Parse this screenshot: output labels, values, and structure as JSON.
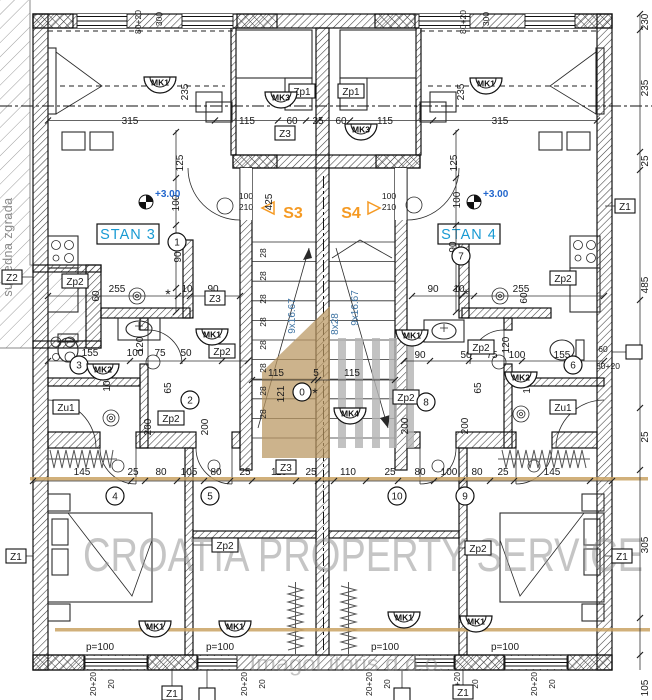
{
  "labels": {
    "stan3": "STAN 3",
    "stan4": "STAN 4",
    "s3": "S3",
    "s4": "S4",
    "level_mark": "+3.00",
    "neighbor": "susjedna zgrada"
  },
  "watermarks": {
    "main": "CROATIA PROPERTY SERVICE",
    "sub": "ImagoLitoris d.o.o."
  },
  "colors": {
    "dimension_text": "#1a1a1a",
    "stair_note_text": "#3f74a3",
    "unit_label_text": "#189ad3",
    "stair_id_text": "#f59a23",
    "level_text": "#2266cc",
    "watermark_tan": "#c9a263",
    "watermark_gray": "#8c8c8c"
  },
  "dim_labels": [
    [
      "80+20",
      141,
      22,
      -90,
      8.5
    ],
    [
      "300",
      162,
      19,
      -90,
      8.5
    ],
    [
      "80+20",
      466,
      22,
      -90,
      8.5
    ],
    [
      "300",
      489,
      19,
      -90,
      8.5
    ],
    [
      "315",
      130,
      124
    ],
    [
      "115",
      247,
      124
    ],
    [
      "60",
      292,
      124
    ],
    [
      "25",
      318,
      124
    ],
    [
      "60",
      341,
      124
    ],
    [
      "115",
      385,
      124
    ],
    [
      "315",
      500,
      124
    ],
    [
      "235",
      188,
      92,
      -90
    ],
    [
      "235",
      464,
      92,
      -90
    ],
    [
      "230",
      648,
      22,
      -90
    ],
    [
      "235",
      648,
      88,
      -90
    ],
    [
      "25",
      648,
      161,
      -90
    ],
    [
      "485",
      648,
      285,
      -90
    ],
    [
      "25",
      648,
      437,
      -90
    ],
    [
      "305",
      648,
      545,
      -90
    ],
    [
      "105",
      648,
      688,
      -90
    ],
    [
      "125",
      183,
      163,
      -90
    ],
    [
      "125",
      457,
      163,
      -90
    ],
    [
      "100",
      179,
      203,
      -90
    ],
    [
      "100",
      460,
      200,
      -90
    ],
    [
      "90",
      181,
      257,
      -90
    ],
    [
      "90",
      456,
      247,
      -90
    ],
    [
      "100",
      246,
      199,
      0,
      8.5
    ],
    [
      "210",
      246,
      210,
      0,
      8.5
    ],
    [
      "100",
      389,
      199,
      0,
      8.5
    ],
    [
      "210",
      389,
      210,
      0,
      8.5
    ],
    [
      "425",
      272,
      202,
      -90
    ],
    [
      "9x16.67",
      295,
      316,
      -90,
      10,
      "blue"
    ],
    [
      "8x28",
      338,
      324,
      -90,
      10,
      "blue"
    ],
    [
      "9x16.67",
      358,
      308,
      -90,
      10,
      "blue"
    ],
    [
      "28",
      266,
      253,
      -90,
      8.5
    ],
    [
      "28",
      266,
      276,
      -90,
      8.5
    ],
    [
      "28",
      266,
      299,
      -90,
      8.5
    ],
    [
      "28",
      266,
      322,
      -90,
      8.5
    ],
    [
      "28",
      266,
      345,
      -90,
      8.5
    ],
    [
      "28",
      266,
      368,
      -90,
      8.5
    ],
    [
      "28",
      266,
      391,
      -90,
      8.5
    ],
    [
      "28",
      266,
      414,
      -90,
      8.5
    ],
    [
      "115",
      276,
      376
    ],
    [
      "5",
      316,
      376
    ],
    [
      "115",
      352,
      376
    ],
    [
      "121",
      284,
      394,
      -90
    ],
    [
      "90",
      420,
      358
    ],
    [
      "255",
      117,
      292
    ],
    [
      "10",
      187,
      292
    ],
    [
      "90",
      213,
      292
    ],
    [
      "60",
      99,
      296,
      -90
    ],
    [
      "255",
      521,
      292
    ],
    [
      "10",
      459,
      292
    ],
    [
      "90",
      433,
      292
    ],
    [
      "60",
      527,
      298,
      -90
    ],
    [
      "*",
      168,
      299,
      0,
      14
    ],
    [
      "*",
      466,
      299,
      0,
      14
    ],
    [
      "*",
      315,
      398,
      0,
      14
    ],
    [
      "155",
      90,
      356
    ],
    [
      "100",
      135,
      356
    ],
    [
      "75",
      160,
      356
    ],
    [
      "50",
      186,
      356
    ],
    [
      "50",
      466,
      358
    ],
    [
      "75",
      492,
      358
    ],
    [
      "100",
      517,
      358
    ],
    [
      "155",
      562,
      358
    ],
    [
      "120",
      143,
      345,
      -90
    ],
    [
      "10",
      110,
      386,
      -90
    ],
    [
      "120",
      509,
      345,
      -90
    ],
    [
      "10",
      530,
      388,
      -90
    ],
    [
      "65",
      171,
      388,
      -90
    ],
    [
      "65",
      481,
      388,
      -90
    ],
    [
      "200",
      151,
      427,
      -90
    ],
    [
      "200",
      208,
      427,
      -90
    ],
    [
      "200",
      408,
      426,
      -90
    ],
    [
      "200",
      468,
      426,
      -90
    ],
    [
      "60",
      603,
      352,
      0,
      8.5
    ],
    [
      "80+20",
      608,
      369,
      0,
      8.5
    ],
    [
      "145",
      82,
      475
    ],
    [
      "25",
      133,
      475
    ],
    [
      "80",
      161,
      475
    ],
    [
      "105",
      189,
      475
    ],
    [
      "80",
      216,
      475
    ],
    [
      "25",
      245,
      475
    ],
    [
      "110",
      279,
      475
    ],
    [
      "25",
      311,
      475
    ],
    [
      "110",
      348,
      475
    ],
    [
      "25",
      390,
      475
    ],
    [
      "80",
      420,
      475
    ],
    [
      "100",
      449,
      475
    ],
    [
      "80",
      477,
      475
    ],
    [
      "25",
      503,
      475
    ],
    [
      "145",
      552,
      475
    ],
    [
      "p=100",
      100,
      650
    ],
    [
      "p=100",
      220,
      650
    ],
    [
      "p=100",
      385,
      650
    ],
    [
      "p=100",
      505,
      650
    ],
    [
      "20+20",
      96,
      684,
      -90,
      8.5
    ],
    [
      "20",
      114,
      684,
      -90,
      8.5
    ],
    [
      "20+20",
      247,
      684,
      -90,
      8.5
    ],
    [
      "20",
      265,
      684,
      -90,
      8.5
    ],
    [
      "20+20",
      372,
      684,
      -90,
      8.5
    ],
    [
      "20",
      390,
      684,
      -90,
      8.5
    ],
    [
      "20+20",
      460,
      684,
      -90,
      8.5
    ],
    [
      "20",
      478,
      684,
      -90,
      8.5
    ],
    [
      "20+20",
      537,
      684,
      -90,
      8.5
    ],
    [
      "20",
      555,
      684,
      -90,
      8.5
    ]
  ],
  "boxed_labels": [
    [
      "Z1",
      625,
      206
    ],
    [
      "Z1",
      622,
      556
    ],
    [
      "Z1",
      16,
      556
    ],
    [
      "Z1",
      172,
      693
    ],
    [
      "Z1",
      463,
      692
    ],
    [
      "Z2",
      12,
      277
    ],
    [
      "Z3",
      285,
      133
    ],
    [
      "Z3",
      215,
      298
    ],
    [
      "Z3",
      286,
      467
    ],
    [
      "Zp1",
      302,
      91
    ],
    [
      "Zp1",
      351,
      91
    ],
    [
      "Zp2",
      75,
      281
    ],
    [
      "Zp2",
      563,
      278
    ],
    [
      "Zp2",
      222,
      351
    ],
    [
      "Zp2",
      481,
      347
    ],
    [
      "Zp2",
      171,
      418
    ],
    [
      "Zp2",
      406,
      397
    ],
    [
      "Zp2",
      225,
      545
    ],
    [
      "Zp2",
      478,
      548
    ],
    [
      "Zu1",
      66,
      407
    ],
    [
      "Zu1",
      563,
      407
    ]
  ],
  "circled_labels": [
    [
      "1",
      177,
      242
    ],
    [
      "2",
      190,
      400
    ],
    [
      "3",
      79,
      365
    ],
    [
      "4",
      115,
      496
    ],
    [
      "5",
      210,
      496
    ],
    [
      "6",
      573,
      365
    ],
    [
      "7",
      461,
      256
    ],
    [
      "8",
      426,
      402
    ],
    [
      "9",
      465,
      496
    ],
    [
      "10",
      397,
      496
    ],
    [
      "0",
      302,
      392
    ]
  ],
  "mk_labels": [
    [
      "MK1",
      160,
      77
    ],
    [
      "MK1",
      486,
      78
    ],
    [
      "MK1",
      212,
      329
    ],
    [
      "MK1",
      412,
      330
    ],
    [
      "MK1",
      155,
      621
    ],
    [
      "MK1",
      235,
      621
    ],
    [
      "MK1",
      404,
      612
    ],
    [
      "MK1",
      476,
      616
    ],
    [
      "MK2",
      103,
      364
    ],
    [
      "MK2",
      521,
      372
    ],
    [
      "MK3",
      281,
      92
    ],
    [
      "MK3",
      361,
      124
    ],
    [
      "MK4",
      350,
      408
    ]
  ],
  "level_marks": [
    [
      146,
      202
    ],
    [
      474,
      202
    ]
  ],
  "leader_squares": [
    [
      634,
      352
    ],
    [
      207,
      695
    ],
    [
      402,
      695
    ]
  ]
}
